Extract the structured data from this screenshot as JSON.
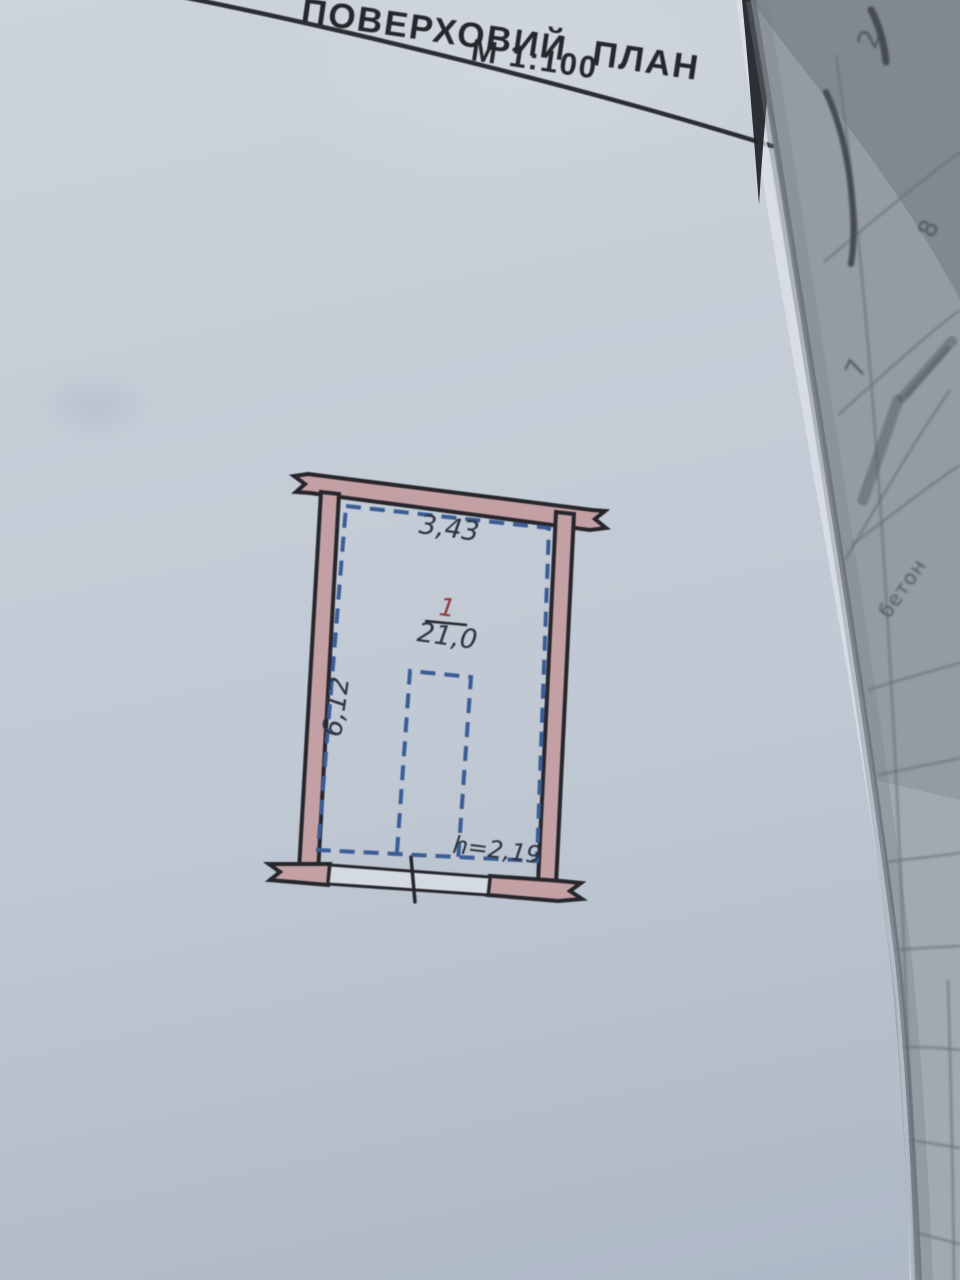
{
  "header": {
    "title": "ПОВЕРХОВИЙ ПЛАН",
    "scale": "М 1:100"
  },
  "plan": {
    "room_number": "1",
    "room_area": "21,0",
    "width_dim": "3,43",
    "depth_dim": "6,12",
    "height_note": "h=2,19"
  },
  "adjacent_page": {
    "digit_top": "2",
    "digit_mid": "8",
    "digit_lower": "7",
    "word_fragment": "бетон"
  },
  "colors": {
    "wall_fill": "#c3a0a3",
    "wall_outline": "#26262c",
    "dashed_blue": "#3b5c95",
    "label_ink": "#2d3340",
    "room_number_red": "#8d3a3a",
    "title_ink": "#26272c",
    "page": "#c6cdd7",
    "adjacent_page": "#949ba4"
  }
}
